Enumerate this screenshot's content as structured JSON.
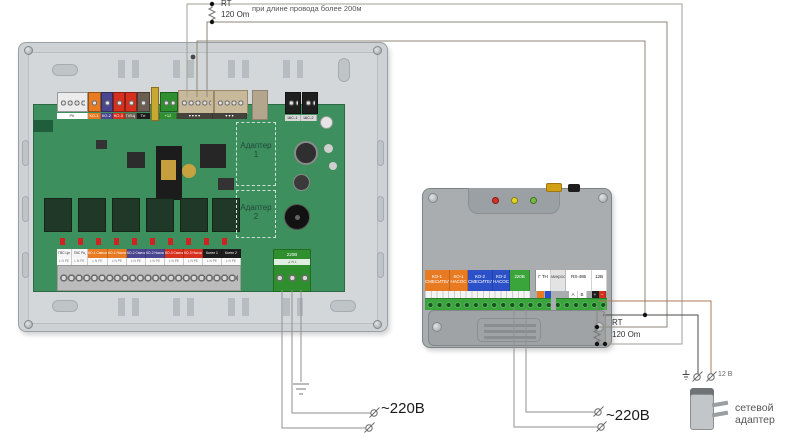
{
  "colors": {
    "wire_a": "#a29d94",
    "wire_b": "#8b867e",
    "wire_common": "#8f8678",
    "wire_plus": "#ad7a55",
    "wire_minus": "#4a4a4a",
    "wire_mains": "#8f8f8f",
    "pcb_green": "#3e8f5e",
    "enclosure_gray": "#ced2d5",
    "device_gray": "#a9adb0",
    "orange": "#e87a22",
    "blue": "#2b50c8",
    "navy": "#4a4590",
    "red": "#d6311f",
    "green": "#3aa53a",
    "black": "#1d1d1d"
  },
  "top_note": {
    "rt": "RT",
    "resistor": "120 Om",
    "condition": "при длине провода более 200м"
  },
  "right_note": {
    "rt": "RT",
    "resistor": "120 Om"
  },
  "left_board": {
    "adapter1": "Адаптер\n1",
    "adapter2": "Адаптер\n2",
    "power_chip": {
      "t": "220В",
      "bg": "#2f8f2f",
      "fg": "#ffffff"
    },
    "top_chips": [
      {
        "t": "РК",
        "bg": "#ffffff",
        "fg": "#444",
        "w": 31,
        "n": "terminal-label-rk"
      },
      {
        "t": "КО-1",
        "bg": "#e87a22",
        "fg": "#fff",
        "w": 13,
        "n": "terminal-label-ko1"
      },
      {
        "t": "КО-2",
        "bg": "#4a4590",
        "fg": "#fff",
        "w": 12,
        "n": "terminal-label-ko2"
      },
      {
        "t": "КО-3",
        "bg": "#d6311f",
        "fg": "#fff",
        "w": 12,
        "n": "terminal-label-ko3"
      },
      {
        "t": "ПЛЩ",
        "bg": "#6b5d4f",
        "fg": "#fff",
        "w": 12,
        "n": "terminal-label-plsch"
      },
      {
        "t": "Тн",
        "bg": "#1d1d1d",
        "fg": "#fff",
        "w": 13,
        "n": "terminal-label-tn"
      },
      {
        "t": "",
        "bg": "transparent",
        "fg": "#444",
        "w": 10,
        "n": "spacer"
      },
      {
        "t": "+12",
        "bg": "#2f8f2f",
        "fg": "#fff",
        "w": 17,
        "n": "terminal-label-12v"
      },
      {
        "t": "▾ ▾ ▾ ▾",
        "bg": "#44423a",
        "fg": "#fff",
        "w": 36,
        "n": "terminal-label-bus-1"
      },
      {
        "t": "▾ ▾ ▾",
        "bg": "#44423a",
        "fg": "#fff",
        "w": 34,
        "n": "terminal-label-bus-2"
      }
    ],
    "shs_chips": [
      {
        "t": "ШС-1",
        "w": 16,
        "n": "terminal-label-shs1"
      },
      {
        "t": "ШС-2",
        "w": 16,
        "n": "terminal-label-shs2"
      }
    ],
    "bottom_chips": [
      {
        "t": "ГВС Цн",
        "bg": "#f5f5f5",
        "fg": "#333",
        "w": 15,
        "n": "terminal-gvs-cn"
      },
      {
        "t": "ГВС Рц",
        "bg": "#f5f5f5",
        "fg": "#333",
        "w": 16,
        "n": "terminal-gvs-rc"
      },
      {
        "t": "КО-1 Смесит",
        "bg": "#e87a22",
        "fg": "#fff",
        "w": 20,
        "n": "terminal-ko1-mixer"
      },
      {
        "t": "КО-1 Насос",
        "bg": "#e87a22",
        "fg": "#fff",
        "w": 19,
        "n": "terminal-ko1-pump"
      },
      {
        "t": "КО-2 Смесит",
        "bg": "#4a4590",
        "fg": "#fff",
        "w": 19,
        "n": "terminal-ko2-mixer"
      },
      {
        "t": "КО-2 Насос",
        "bg": "#4a4590",
        "fg": "#fff",
        "w": 19,
        "n": "terminal-ko2-pump"
      },
      {
        "t": "КО-3 Смесит",
        "bg": "#d6311f",
        "fg": "#fff",
        "w": 19,
        "n": "terminal-ko3-mixer"
      },
      {
        "t": "КО-3 Насос",
        "bg": "#d6311f",
        "fg": "#fff",
        "w": 19,
        "n": "terminal-ko3-pump"
      },
      {
        "t": "Котел 1",
        "bg": "#1d1d1d",
        "fg": "#fff",
        "w": 19,
        "n": "terminal-boiler-1"
      },
      {
        "t": "Котел 2",
        "bg": "#1d1d1d",
        "fg": "#fff",
        "w": 19,
        "n": "terminal-boiler-2"
      }
    ],
    "bottom_sub_text": "L N PE"
  },
  "right_device": {
    "sections": [
      {
        "t": "КО-1\nСМЕСИТЕЛЬ",
        "bg": "#e87a22",
        "fg": "#fff",
        "w": 25,
        "n": "terminal-ko1-mixer"
      },
      {
        "t": "КО-1\nНАСОС",
        "bg": "#e87a22",
        "fg": "#fff",
        "w": 18,
        "n": "terminal-ko1-pump"
      },
      {
        "t": "КО-2\nСМЕСИТЕЛЬ",
        "bg": "#2b50c8",
        "fg": "#fff",
        "w": 25,
        "n": "terminal-ko2-mixer"
      },
      {
        "t": "КО-2\nНАСОС",
        "bg": "#2b50c8",
        "fg": "#fff",
        "w": 17,
        "n": "terminal-ko2-pump"
      },
      {
        "t": "220В",
        "bg": "#3aa53a",
        "fg": "#fff",
        "w": 20,
        "n": "terminal-220v"
      },
      {
        "t": "",
        "bg": "transparent",
        "fg": "#000",
        "w": 6,
        "n": "gap"
      },
      {
        "t": "Г ТН",
        "bg": "#ffffff",
        "fg": "#222",
        "w": 15,
        "n": "terminal-gtn"
      },
      {
        "t": "микрофон",
        "bg": "#e3e3e3",
        "fg": "#555",
        "w": 15,
        "n": "terminal-microphone"
      },
      {
        "t": "RS-485",
        "bg": "#ffffff",
        "fg": "#222",
        "w": 26,
        "n": "terminal-rs485"
      },
      {
        "t": "12В",
        "bg": "#ffffff",
        "fg": "#222",
        "w": 15,
        "n": "terminal-12v"
      }
    ],
    "sub_cells": [
      {
        "t": "A",
        "bg": "#ffffff",
        "fg": "#333",
        "w": 9,
        "n": "rs485-a"
      },
      {
        "t": "B",
        "bg": "#ffffff",
        "fg": "#333",
        "w": 9,
        "n": "rs485-b"
      },
      {
        "t": "+",
        "bg": "#1d1d1d",
        "fg": "#fff",
        "w": 7,
        "ml": 5,
        "n": "12v-plus"
      },
      {
        "t": "−",
        "bg": "#d6311f",
        "fg": "#fff",
        "w": 7,
        "n": "12v-minus"
      }
    ]
  },
  "labels": {
    "mains_left": "~220В",
    "mains_right": "~220В",
    "adapter_caption": "сетевой адаптер",
    "adapter_voltage": "12 В"
  }
}
